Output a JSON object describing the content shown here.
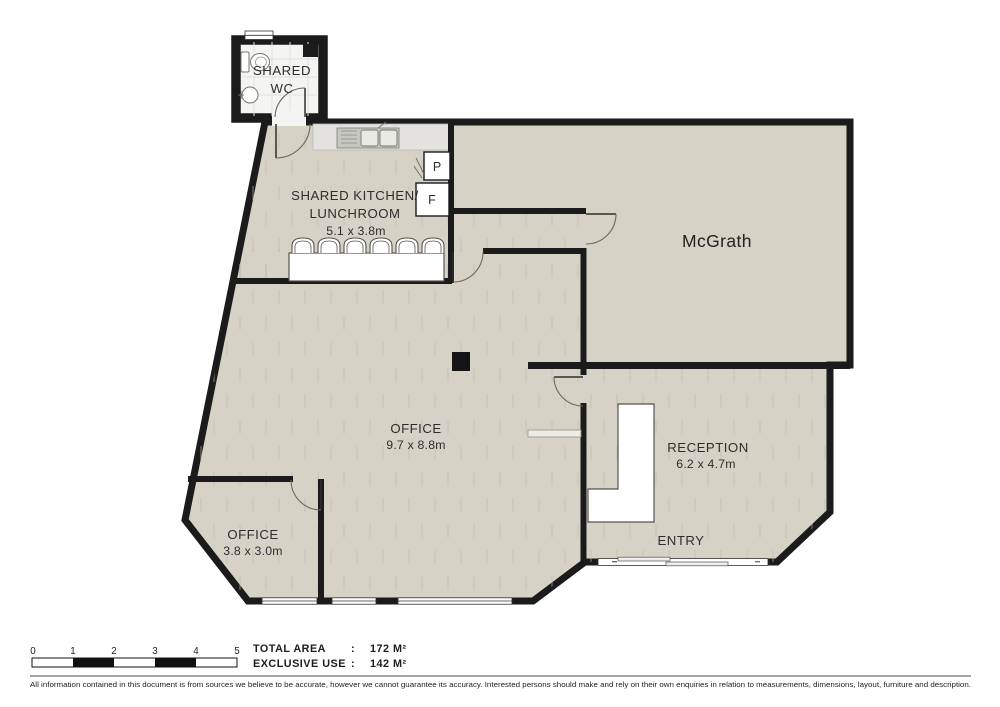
{
  "colors": {
    "floor": "#d6d2c6",
    "wall": "#1b1b1b",
    "counter": "#e3e2de",
    "wc_floor": "#f4f4f2",
    "texture": "#bdb8a9"
  },
  "rooms": {
    "shared_wc": {
      "line1": "SHARED",
      "line2": "WC"
    },
    "kitchen": {
      "line1": "SHARED KITCHEN/",
      "line2": "LUNCHROOM",
      "dims": "5.1 x 3.8m"
    },
    "mcgrath": {
      "name": "McGrath"
    },
    "office_main": {
      "name": "OFFICE",
      "dims": "9.7 x 8.8m"
    },
    "office_small": {
      "name": "OFFICE",
      "dims": "3.8 x 3.0m"
    },
    "reception": {
      "name": "RECEPTION",
      "dims": "6.2 x 4.7m"
    },
    "entry": {
      "name": "ENTRY"
    }
  },
  "appliances": {
    "pantry": "P",
    "fridge": "F"
  },
  "legend": {
    "scale_ticks": [
      "0",
      "1",
      "2",
      "3",
      "4",
      "5"
    ],
    "total_area_label": "TOTAL AREA",
    "separator": ":",
    "total_area_value": "172 M²",
    "exclusive_use_label": "EXCLUSIVE USE",
    "exclusive_use_value": "142 M²"
  },
  "disclaimer": "All information contained in this document is from sources we believe to be accurate, however we cannot guarantee its accuracy. Interested persons should make and rely on their own enquiries in relation to measurements, dimensions, layout, furniture and description."
}
